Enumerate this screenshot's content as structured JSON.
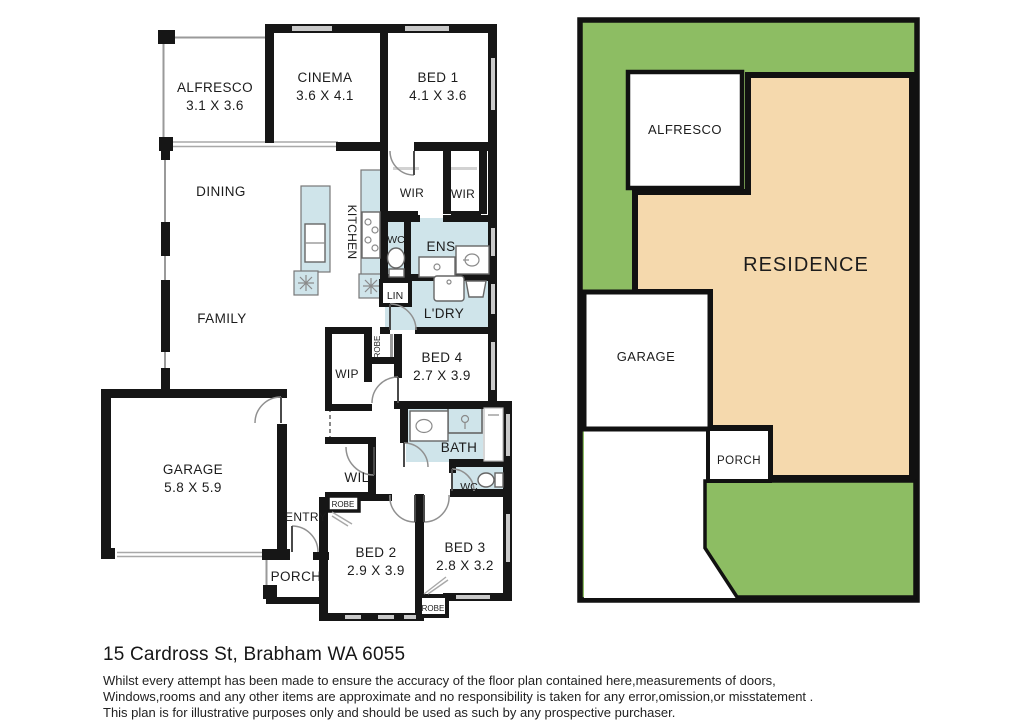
{
  "colors": {
    "wall": "#161616",
    "wet_area": "#cfe4ea",
    "grass": "#8dbd63",
    "residence": "#f5d9ad"
  },
  "floorplan": {
    "alfresco_label": "ALFRESCO",
    "alfresco_dims": "3.1 X 3.6",
    "cinema_label": "CINEMA",
    "cinema_dims": "3.6 X 4.1",
    "bed1_label": "BED 1",
    "bed1_dims": "4.1 X 3.6",
    "dining_label": "DINING",
    "kitchen_label": "KITCHEN",
    "wir1_label": "WIR",
    "wir2_label": "WIR",
    "wc1_label": "WC",
    "ens_label": "ENS",
    "lin_label": "LIN",
    "ldry_label": "L'DRY",
    "family_label": "FAMILY",
    "wip_label": "WIP",
    "robe1_label": "ROBE",
    "bed4_label": "BED 4",
    "bed4_dims": "2.7 X 3.9",
    "garage_label": "GARAGE",
    "garage_dims": "5.8 X 5.9",
    "wil_label": "WIL",
    "bath_label": "BATH",
    "wc2_label": "WC",
    "entry_label": "ENTRY",
    "robe2_label": "ROBE",
    "porch_label": "PORCH",
    "bed2_label": "BED 2",
    "bed2_dims": "2.9 X 3.9",
    "bed3_label": "BED 3",
    "bed3_dims": "2.8 X 3.2",
    "robe3_label": "ROBE"
  },
  "siteplan": {
    "alfresco_label": "ALFRESCO",
    "residence_label": "RESIDENCE",
    "garage_label": "GARAGE",
    "porch_label": "PORCH"
  },
  "footer": {
    "address": "15 Cardross St, Brabham WA 6055",
    "disclaimer_line1": "Whilst every attempt has been made to ensure the accuracy of the floor plan contained here,measurements of doors,",
    "disclaimer_line2": "Windows,rooms and any other items are approximate and no responsibility is taken for any error,omission,or misstatement .",
    "disclaimer_line3": "This plan is for illustrative purposes only and should be used as such by any prospective purchaser."
  }
}
